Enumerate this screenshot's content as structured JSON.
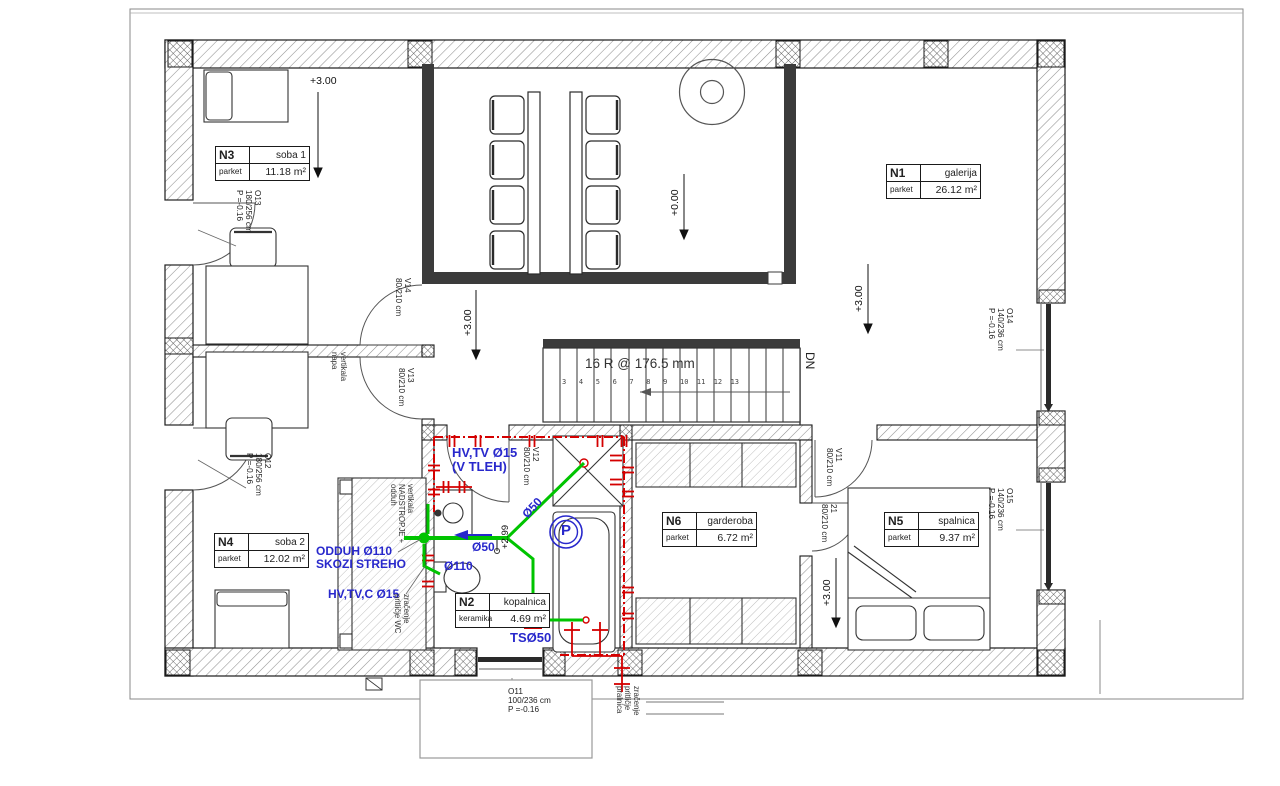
{
  "rooms": {
    "n1": {
      "id": "N1",
      "name": "galerija",
      "floor": "parket",
      "area": "26.12 m²"
    },
    "n2": {
      "id": "N2",
      "name": "kopalnica",
      "floor": "keramika",
      "area": "4.69 m²"
    },
    "n3": {
      "id": "N3",
      "name": "soba 1",
      "floor": "parket",
      "area": "11.18 m²"
    },
    "n4": {
      "id": "N4",
      "name": "soba 2",
      "floor": "parket",
      "area": "12.02 m²"
    },
    "n5": {
      "id": "N5",
      "name": "spalnica",
      "floor": "parket",
      "area": "9.37 m²"
    },
    "n6": {
      "id": "N6",
      "name": "garderoba",
      "floor": "parket",
      "area": "6.72 m²"
    }
  },
  "openings": {
    "o11": "O11\n100/236 cm\nP =-0.16",
    "o12": "O12\n180/256 cm\nP =-0.16",
    "o13": "O13\n180/256 cm\nP =-0.16",
    "o14": "O14\n140/236 cm\nP =-0.16",
    "o15": "O15\n140/236 cm\nP =-0.16",
    "v11": "V11\n80/210 cm",
    "v12": "V12\n80/210 cm",
    "v13": "V13\n80/210 cm",
    "v14": "V14\n80/210 cm",
    "v21": "21\n80/210 cm"
  },
  "levels": {
    "n3": "+3.00",
    "hall": "+3.00",
    "void": "+0.00",
    "gallery": "+3.00",
    "n5": "+3.00",
    "bath": "+2.99"
  },
  "stairs": {
    "note": "16 R @ 176.5 mm",
    "dn": "DN",
    "steps": "3   4   5   6   7   8   9   10  11  12  13"
  },
  "pipe_labels": {
    "hv_tv": "HV,TV Ø15\n(V TLEH)",
    "d50_diag": "Ø50",
    "d50_main": "Ø50",
    "d110": "Ø110",
    "ts50": "TSØ50",
    "odduh": "ODDUH Ø110\nSKOZI STREHO",
    "hv_tv_c": "HV,TV,C Ø15",
    "pump": "P"
  },
  "shaft_labels": {
    "napa": "vertikala\nnapa",
    "nadstropje": "vertikala\nNADSTROPJE +\nodduh",
    "wc_vent": "zračenje\npritličje WC",
    "pralnica_vent": "zračenje\npritličje\npralnica"
  },
  "colors": {
    "pipe_green": "#00c400",
    "annotation_blue": "#2828cc",
    "heating_red": "#d40000"
  }
}
